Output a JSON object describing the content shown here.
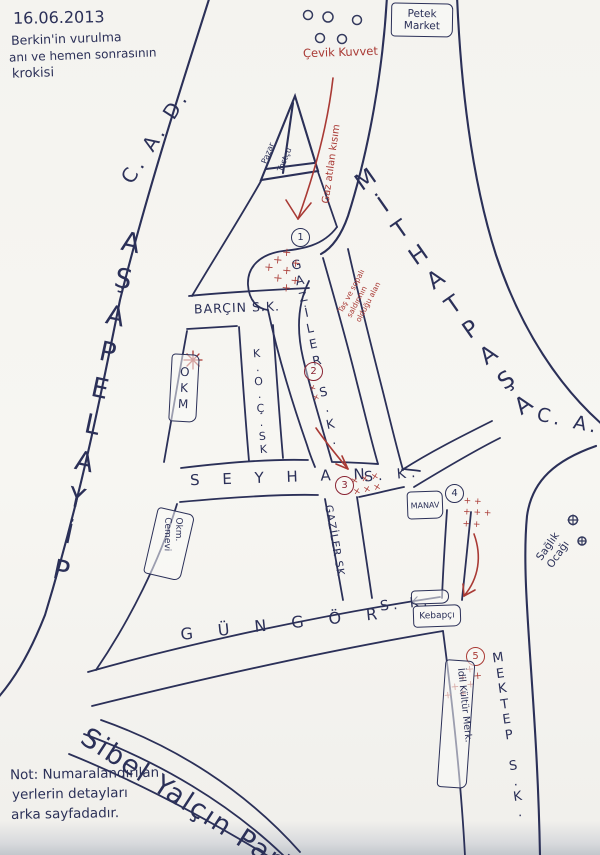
{
  "title": {
    "date": "16.06.2013",
    "line1": "Berkin'in vurulma",
    "line2": "anı ve hemen sonrasının",
    "line3": "krokisi"
  },
  "note": {
    "line1": "Not: Numaralandırılan",
    "line2": "yerlerin detayları",
    "line3": "arka sayfadadır."
  },
  "streets": {
    "mithatpasa_letters": "MİTHATPAŞA",
    "mithatpasa_cad": "C. A. D.",
    "piyalepasa_letters": "PİYALEPAŞA",
    "piyalepasa_cad": "C. A. D.",
    "barcin": "BARÇIN S.K.",
    "koc_letters": "K.O.Ç.SK",
    "gaziler_upper_letters": "GAZİLER S.K.",
    "gaziler_lower": "GAZİLER SK",
    "seyhan_letters": "S E Y H A N",
    "seyhan_sk": "S. K.",
    "gungor_letters": "G Ü N G Ö R",
    "gungor_sk": "S. K.",
    "mektep_letters": "MEKTEP S.K.",
    "sibel_park": "Sibel Yalçın Parkı"
  },
  "places": {
    "petek_line1": "Petek",
    "petek_line2": "Market",
    "cevik_kuvvet": "Çevik Kuvvet",
    "triangle_label1": "Pazar",
    "triangle_label2": "Tostçu",
    "okm": "OKM",
    "okm_cemevi": "Okm. Cemevi",
    "manav": "MANAV",
    "kebapci": "Kebapçı",
    "idil": "İdil Kültür Merk.",
    "saglik_ocagi": "Sağlık\nOcağı"
  },
  "annotations": {
    "gaz_atilan": "Gaz atılan kısım",
    "tas_sopa": "Taş ve sopalı\nsaldırının\nolduğu alan",
    "marks_junction1": "× × ×\n× × ×\n× ×",
    "marks_point2": "×\n×",
    "marks_point3": "× × ×\n× × ×",
    "marks_point4": "+ +\n+ + +\n+ +",
    "marks_point5": "× ×\n× ×\n× ×\n×"
  },
  "markers": {
    "p1": "1",
    "p2": "2",
    "p3": "3",
    "p4": "4",
    "p5": "5"
  },
  "colors": {
    "ink_blue": "#2b3058",
    "ink_red": "#a93a35"
  }
}
